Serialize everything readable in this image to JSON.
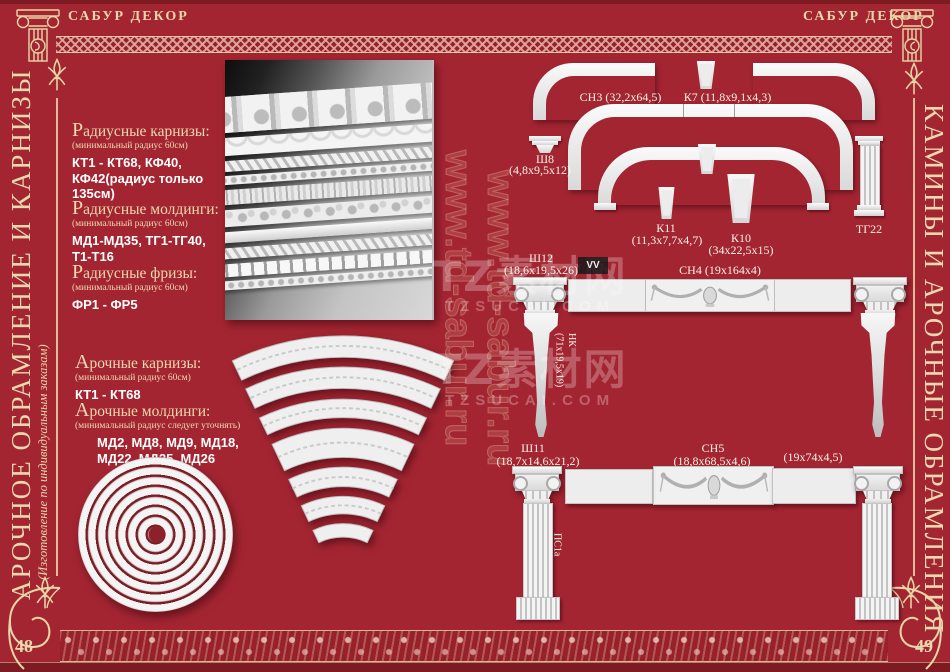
{
  "brand": {
    "left": "САБУР ДЕКОР",
    "right": "САБУР ДЕКОР"
  },
  "left_page": {
    "page_number": "48",
    "side_title": "АРОЧНОЕ ОБРАМЛЕНИЕ И КАРНИЗЫ",
    "side_subtitle": "(Изготовление по индивидуальным заказам)",
    "sections": [
      {
        "heading": "Радиусные карнизы:",
        "note": "(минимальный радиус 60см)",
        "lines": [
          "КТ1 - КТ68, КФ40,",
          "КФ42(радиус только 135см)"
        ]
      },
      {
        "heading": "Радиусные молдинги:",
        "note": "(минимальный радиус 60см)",
        "lines": [
          "МД1-МД35, ТГ1-ТГ40,",
          "Т1-Т16"
        ]
      },
      {
        "heading": "Радиусные фризы:",
        "note": "(минимальный радиус 60см)",
        "lines": [
          "ФР1 - ФР5"
        ]
      },
      {
        "heading": "Арочные карнизы:",
        "note": "(минимальный радиус 60см)",
        "lines": [
          "КТ1 - КТ68"
        ]
      },
      {
        "heading": "Арочные молдинги:",
        "note": "(минимальный радиус следует уточнять)",
        "lines": [
          "МД2, МД8, МД9, МД18,",
          "МД22, МД25, МД26"
        ]
      }
    ]
  },
  "right_page": {
    "page_number": "49",
    "side_title": "КАМИНЫ И АРОЧНЫЕ ОБРАМЛЕНИЯ",
    "labels": {
      "sn3": "СН3 (32,2х64,5)",
      "k7": "К7 (11,8х9,1х4,3)",
      "sh8_code": "Ш8",
      "sh8_dims": "(4,8х9,5х12)",
      "k11_code": "К11",
      "k11_dims": "(11,3х7,7х4,7)",
      "k10_code": "К10",
      "k10_dims": "(34х22,5х15)",
      "tg22": "ТГ22",
      "sh12_code": "Ш12",
      "sh12_dims": "(18,6х19,5х26)",
      "sn4": "СН4 (19х164х4)",
      "nk_code": "НК",
      "nk_dims": "(71х19,5х19)",
      "sh11_code": "Ш11",
      "sh11_dims": "(18,7х14,6х21,2)",
      "sn5_code": "СН5",
      "sn5_dims": "(18,8х68,5х4,6)",
      "ps_right_dims": "(19х74х4,5)",
      "ps1a": "ПС1а"
    }
  },
  "watermarks": {
    "cn": "TZ素材网",
    "site": "TZSUCAI.COM",
    "url_vertical": "www.td-sabur.ru",
    "vv": "VV"
  },
  "colors": {
    "background": "#a42532",
    "cream": "#ead8ae",
    "rose": "#d9a8a0",
    "label": "#f7f2e6"
  }
}
